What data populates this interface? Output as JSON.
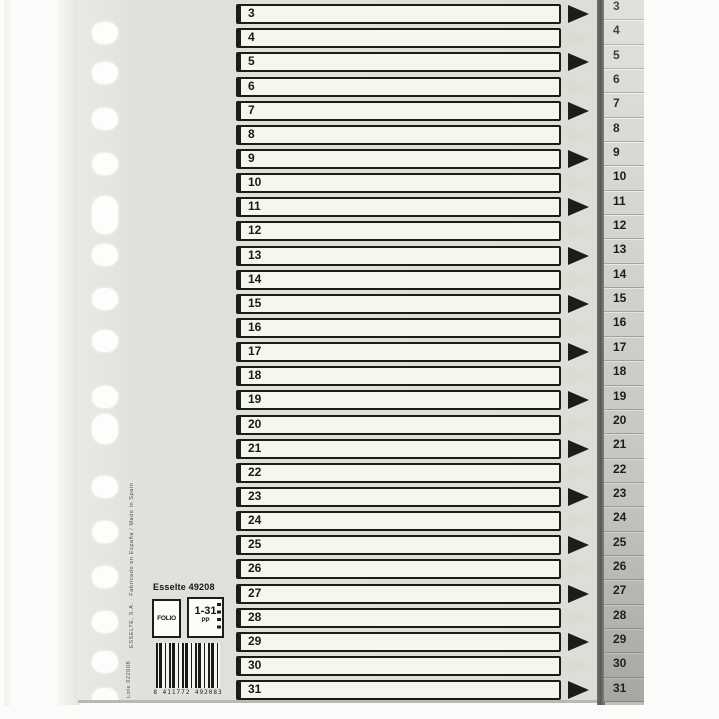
{
  "product_label": {
    "brand_code": "Esselte 49208",
    "format": "FOLIO",
    "range": "1-31",
    "range_unit": "PP",
    "barcode_text": "8 411772 492083",
    "side_text": "ESSELTE, S.A. · Fabricado en España / Made in Spain",
    "lot_text": "Lote 022008"
  },
  "rows": [
    {
      "label": "3",
      "arrow": "black"
    },
    {
      "label": "4",
      "arrow": "faint"
    },
    {
      "label": "5",
      "arrow": "black"
    },
    {
      "label": "6",
      "arrow": "faint"
    },
    {
      "label": "7",
      "arrow": "black"
    },
    {
      "label": "8",
      "arrow": "faint"
    },
    {
      "label": "9",
      "arrow": "black"
    },
    {
      "label": "10",
      "arrow": "faint"
    },
    {
      "label": "11",
      "arrow": "black"
    },
    {
      "label": "12",
      "arrow": "faint"
    },
    {
      "label": "13",
      "arrow": "black"
    },
    {
      "label": "14",
      "arrow": "faint"
    },
    {
      "label": "15",
      "arrow": "black"
    },
    {
      "label": "16",
      "arrow": "faint"
    },
    {
      "label": "17",
      "arrow": "black"
    },
    {
      "label": "18",
      "arrow": "faint"
    },
    {
      "label": "19",
      "arrow": "black"
    },
    {
      "label": "20",
      "arrow": "faint"
    },
    {
      "label": "21",
      "arrow": "black"
    },
    {
      "label": "22",
      "arrow": "faint"
    },
    {
      "label": "23",
      "arrow": "black"
    },
    {
      "label": "24",
      "arrow": "faint"
    },
    {
      "label": "25",
      "arrow": "black"
    },
    {
      "label": "26",
      "arrow": "faint"
    },
    {
      "label": "27",
      "arrow": "black"
    },
    {
      "label": "28",
      "arrow": "faint"
    },
    {
      "label": "29",
      "arrow": "black"
    },
    {
      "label": "30",
      "arrow": "faint"
    },
    {
      "label": "31",
      "arrow": "black"
    }
  ],
  "tabs": [
    {
      "label": "3"
    },
    {
      "label": "4"
    },
    {
      "label": "5"
    },
    {
      "label": "6"
    },
    {
      "label": "7"
    },
    {
      "label": "8"
    },
    {
      "label": "9"
    },
    {
      "label": "10"
    },
    {
      "label": "11"
    },
    {
      "label": "12"
    },
    {
      "label": "13"
    },
    {
      "label": "14"
    },
    {
      "label": "15"
    },
    {
      "label": "16"
    },
    {
      "label": "17"
    },
    {
      "label": "18"
    },
    {
      "label": "19"
    },
    {
      "label": "20"
    },
    {
      "label": "21"
    },
    {
      "label": "22"
    },
    {
      "label": "23"
    },
    {
      "label": "24"
    },
    {
      "label": "25"
    },
    {
      "label": "26"
    },
    {
      "label": "27"
    },
    {
      "label": "28"
    },
    {
      "label": "29"
    },
    {
      "label": "30"
    },
    {
      "label": "31"
    }
  ],
  "colors": {
    "sheet": "#dfe1db",
    "row_fill": "#f6f6ec",
    "ink": "#1d1d18",
    "arrow_faint": "#dadcd4",
    "tab_fill": "#d6d9d2"
  }
}
